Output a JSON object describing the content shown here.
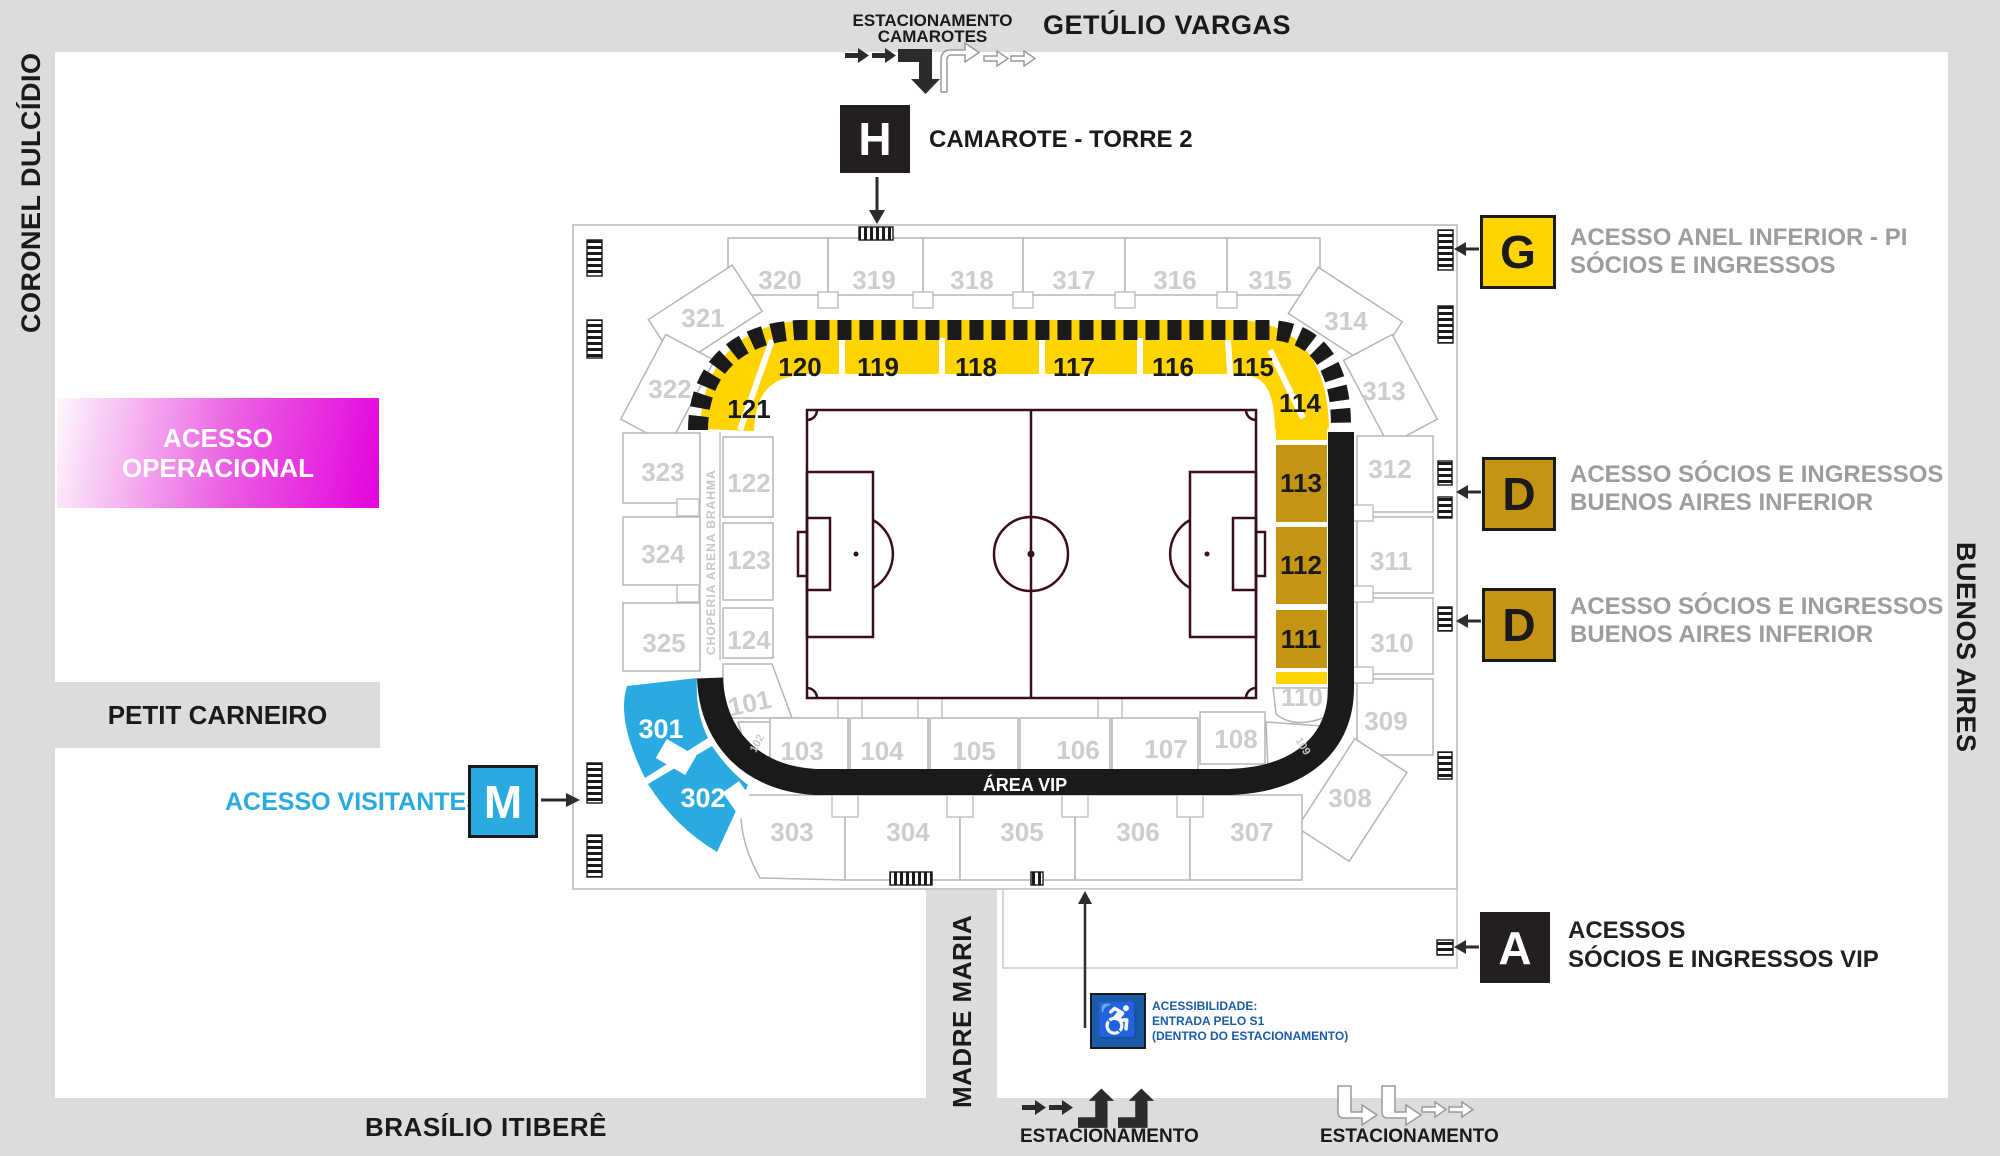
{
  "streets": {
    "top": "GETÚLIO VARGAS",
    "left": "CORONEL DULCÍDIO",
    "right": "BUENOS AIRES",
    "bottom": "BRASÍLIO ITIBERÊ",
    "madre": "MADRE MARIA",
    "petit": "PETIT CARNEIRO"
  },
  "top_parking": {
    "line1": "ESTACIONAMENTO",
    "line2": "CAMAROTES"
  },
  "legend": {
    "h": {
      "letter": "H",
      "label": "CAMAROTE - TORRE 2"
    },
    "g": {
      "letter": "G",
      "line1": "ACESSO ANEL INFERIOR - PI",
      "line2": "SÓCIOS E INGRESSOS"
    },
    "d1": {
      "letter": "D",
      "line1": "ACESSO SÓCIOS E INGRESSOS",
      "line2": "BUENOS AIRES INFERIOR"
    },
    "d2": {
      "letter": "D",
      "line1": "ACESSO SÓCIOS E INGRESSOS",
      "line2": "BUENOS AIRES INFERIOR"
    },
    "a": {
      "letter": "A",
      "line1": "ACESSOS",
      "line2": "SÓCIOS E INGRESSOS VIP"
    },
    "m": {
      "letter": "M",
      "label": "ACESSO VISITANTES"
    },
    "operational": {
      "line1": "ACESSO",
      "line2": "OPERACIONAL"
    }
  },
  "accessibility": {
    "line1": "ACESSIBILIDADE:",
    "line2": "ENTRADA PELO S1",
    "line3": "(DENTRO DO ESTACIONAMENTO)"
  },
  "bottom_parking": {
    "left": "ESTACIONAMENTO",
    "right": "ESTACIONAMENTO"
  },
  "stadium": {
    "area_vip": "ÁREA VIP",
    "choperia": "CHOPERIA ARENA BRAHMA",
    "outer_top": [
      "320",
      "319",
      "318",
      "317",
      "316",
      "315"
    ],
    "corner_tl": [
      "321",
      "322"
    ],
    "outer_left": [
      "323",
      "324",
      "325"
    ],
    "corner_tr": [
      "314",
      "313"
    ],
    "outer_right": [
      "312",
      "311",
      "310",
      "309"
    ],
    "corner_br": [
      "308"
    ],
    "outer_bottom": [
      "303",
      "304",
      "305",
      "306",
      "307"
    ],
    "inner_top": [
      "121",
      "120",
      "119",
      "118",
      "117",
      "116",
      "115",
      "114"
    ],
    "inner_left": [
      "122",
      "123",
      "124"
    ],
    "inner_right": [
      "113",
      "112",
      "111"
    ],
    "inner_bottom": [
      "101",
      "102",
      "103",
      "104",
      "105",
      "106",
      "107",
      "108",
      "109",
      "110"
    ],
    "visitor_sections": [
      "301",
      "302"
    ]
  },
  "icons": {
    "wheelchair": "♿"
  },
  "colors": {
    "yellow": "#FFD400",
    "gold": "#C59412",
    "visitor_blue": "#29ABE2",
    "magenta": "#E303DD",
    "dark": "#231F20",
    "street_gray": "#DCDCDC",
    "muted_text": "#9D9D9D",
    "accessibility_blue": "#1B5BA8",
    "pitch_line": "#3A0E18",
    "section_number_gray": "#CDCDCD"
  }
}
